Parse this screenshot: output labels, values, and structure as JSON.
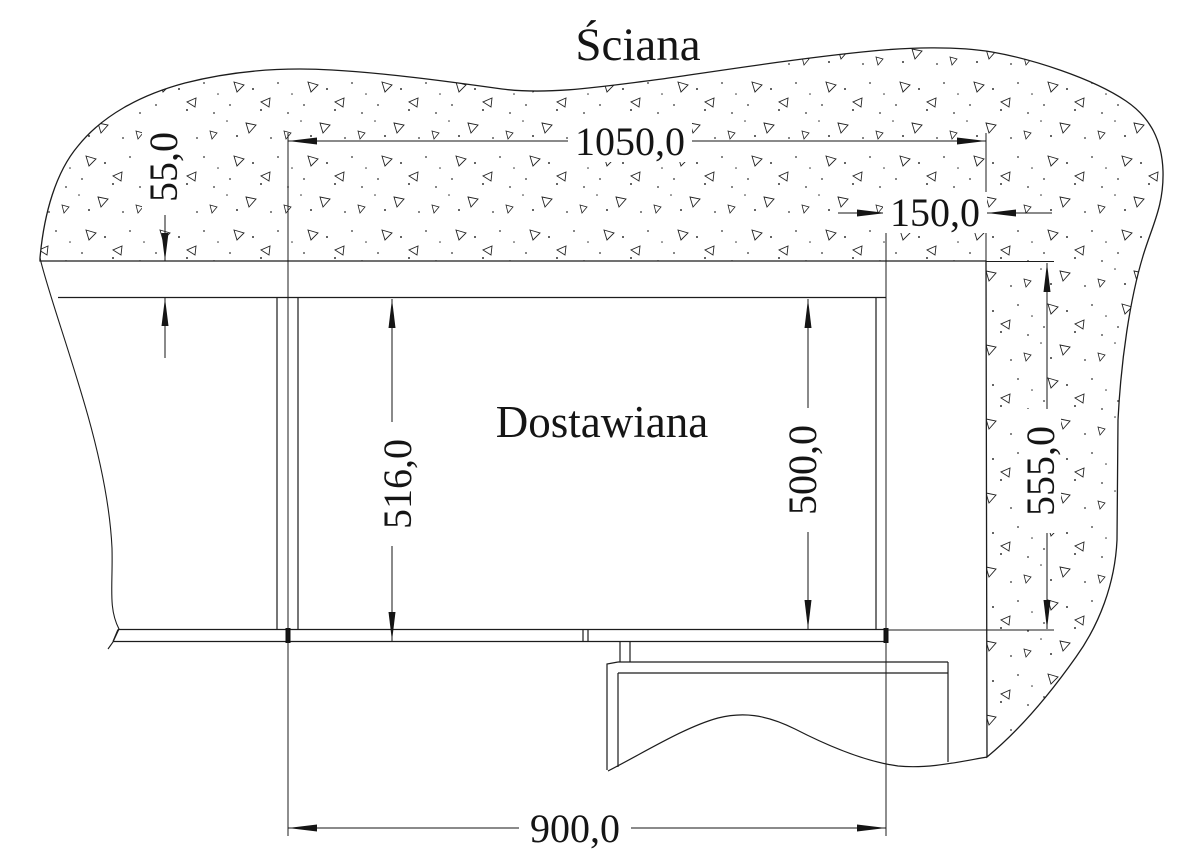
{
  "drawing": {
    "wall_label": "Ściana",
    "cabinet_label": "Dostawiana",
    "dimensions": {
      "top_width": "1050,0",
      "right_offset": "150,0",
      "back_gap": "55,0",
      "depth_left": "516,0",
      "depth_right": "500,0",
      "wall_span": "555,0",
      "bottom_width": "900,0"
    }
  }
}
